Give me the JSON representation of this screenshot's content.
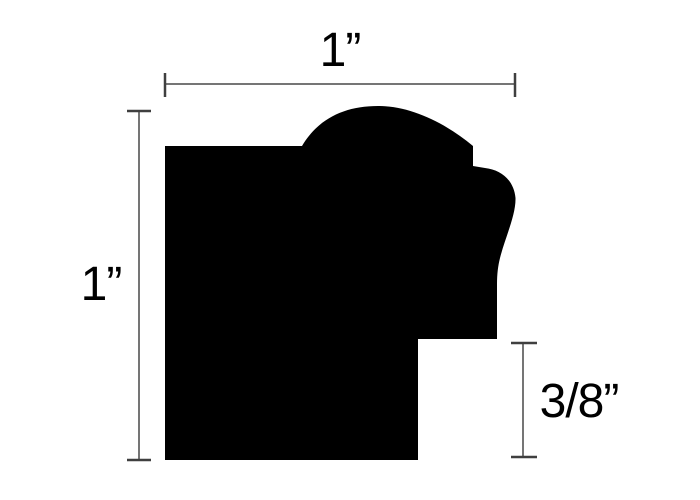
{
  "diagram": {
    "type": "technical-drawing",
    "subject": "picture-frame moulding profile cross-section",
    "background_color": "#ffffff",
    "shape_color": "#000000",
    "dim_line_color": "#757575",
    "dim_tick_color": "#3f3f3f",
    "text_color": "#000000",
    "profile": {
      "path": "M 165,146 L 302,146 C 318,119 344,106 378,106 C 410,106 444,122 473,146 L 473,166 L 485,168 C 502,170 514,181 515.5,198 C 516,215 505,238 500,258 C 498,266 497,274 497,284 L 497,339 L 418,339 L 418,460 L 165,460 Z"
    },
    "dimensions": {
      "width": {
        "label": "1”",
        "orientation": "horizontal",
        "measures": "overall width"
      },
      "height": {
        "label": "1”",
        "orientation": "vertical",
        "measures": "overall height"
      },
      "rabbet": {
        "label": "3/8”",
        "orientation": "vertical",
        "measures": "rabbet depth"
      }
    }
  }
}
